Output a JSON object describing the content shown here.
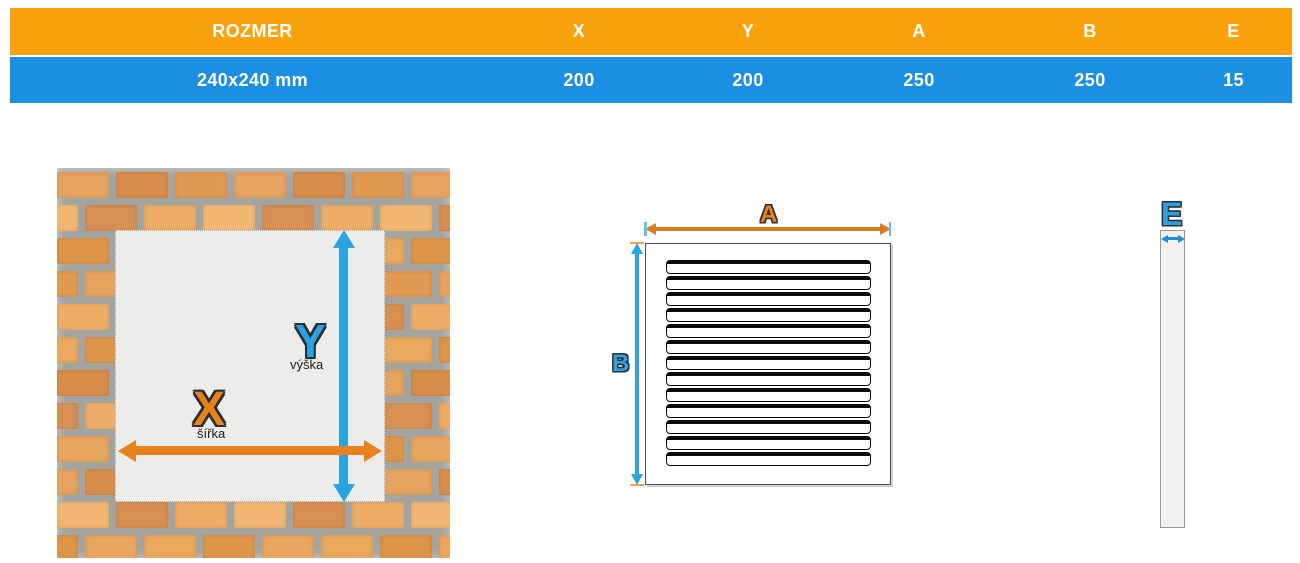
{
  "colors": {
    "table_header_bg": "#F9A20D",
    "table_row_bg": "#1B8FE1",
    "table_text": "#FFFFFF",
    "accent_orange": "#E8821E",
    "accent_blue": "#29A3E3",
    "mortar_gray": "#A3A39F",
    "opening_gray": "#ECECEA"
  },
  "table": {
    "columns": [
      {
        "label": "ROZMER"
      },
      {
        "label": "X"
      },
      {
        "label": "Y"
      },
      {
        "label": "A"
      },
      {
        "label": "B"
      },
      {
        "label": "E"
      }
    ],
    "row": {
      "rozmer": "240x240 mm",
      "x": "200",
      "y": "200",
      "a": "250",
      "b": "250",
      "e": "15"
    }
  },
  "wall_diagram": {
    "x_label": "X",
    "x_sublabel": "šířka",
    "y_label": "Y",
    "y_sublabel": "výška",
    "brick_palette": [
      "#e6a35f",
      "#dd9549",
      "#efae68",
      "#d98e4c",
      "#e8a660",
      "#f2b873",
      "#e09a52",
      "#eaa85e",
      "#d88f52"
    ]
  },
  "grille_diagram": {
    "a_label": "A",
    "b_label": "B",
    "slat_count": 13
  },
  "profile_diagram": {
    "e_label": "E"
  }
}
